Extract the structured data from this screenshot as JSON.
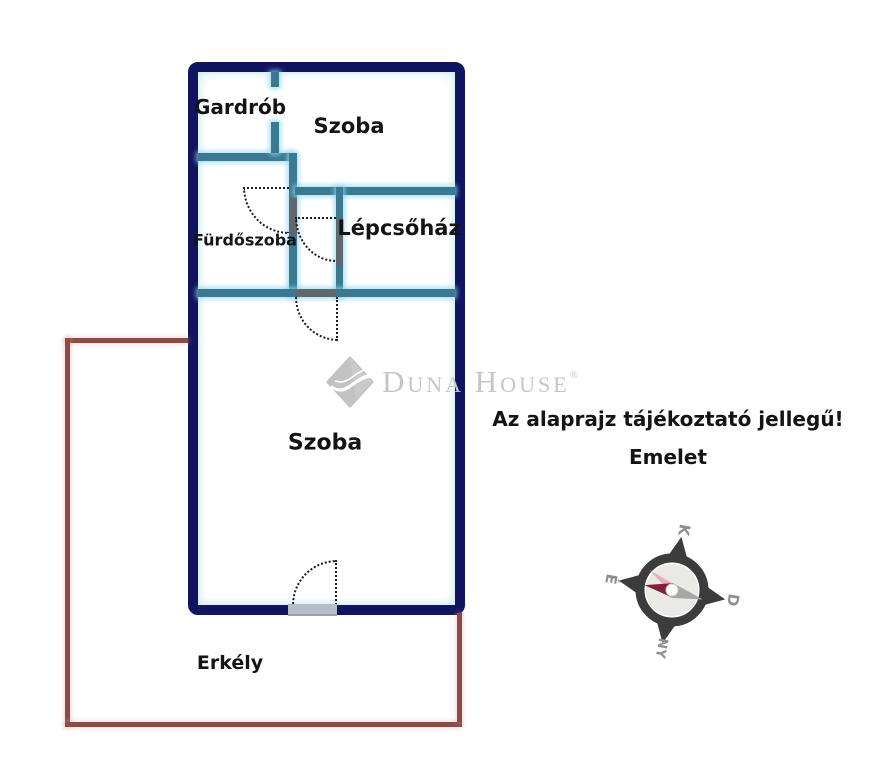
{
  "floorplan": {
    "rooms": [
      {
        "id": "gardrob",
        "label": "Gardrób"
      },
      {
        "id": "szoba_felso",
        "label": "Szoba"
      },
      {
        "id": "furdoszoba",
        "label": "Fürdőszoba"
      },
      {
        "id": "lepcsohaz",
        "label": "Lépcsőház"
      },
      {
        "id": "szoba_also",
        "label": "Szoba"
      },
      {
        "id": "erkely",
        "label": "Erkély"
      }
    ]
  },
  "notice": {
    "disclaimer": "Az alaprajz tájékoztató jellegű!",
    "floor_label": "Emelet"
  },
  "watermark": {
    "brand": "Duna House",
    "registered": "®"
  },
  "compass": {
    "labels": {
      "north": "É",
      "east": "K",
      "south": "D",
      "west": "NY"
    }
  },
  "colors": {
    "outer_wall": "#11155f",
    "inner_wall": "#3b7991",
    "door_leaf": "#5e686d",
    "door_sill": "#b9bdc9",
    "balcony": "#8d4b48",
    "text": "#141414",
    "watermark_gray": "#c6c6c6",
    "compass_dark": "#3c3c3c",
    "needle_red": "#7e1f3e",
    "needle_gray": "#a6a6a6",
    "compass_label": "#8f8f8f"
  }
}
